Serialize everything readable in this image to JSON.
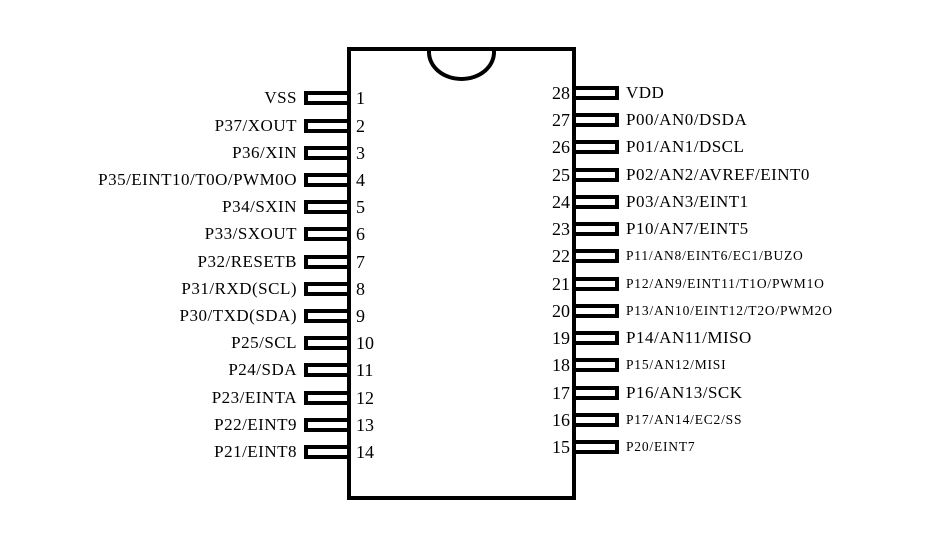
{
  "colors": {
    "line": "#000000",
    "background": "#ffffff"
  },
  "chip": {
    "left_pins": [
      {
        "number": "1",
        "label": "VSS"
      },
      {
        "number": "2",
        "label": "P37/XOUT"
      },
      {
        "number": "3",
        "label": "P36/XIN"
      },
      {
        "number": "4",
        "label": "P35/EINT10/T0O/PWM0O"
      },
      {
        "number": "5",
        "label": "P34/SXIN"
      },
      {
        "number": "6",
        "label": "P33/SXOUT"
      },
      {
        "number": "7",
        "label": "P32/RESETB"
      },
      {
        "number": "8",
        "label": "P31/RXD(SCL)"
      },
      {
        "number": "9",
        "label": "P30/TXD(SDA)"
      },
      {
        "number": "10",
        "label": "P25/SCL"
      },
      {
        "number": "11",
        "label": "P24/SDA"
      },
      {
        "number": "12",
        "label": "P23/EINTA"
      },
      {
        "number": "13",
        "label": "P22/EINT9"
      },
      {
        "number": "14",
        "label": "P21/EINT8"
      }
    ],
    "right_pins": [
      {
        "number": "28",
        "label": "VDD"
      },
      {
        "number": "27",
        "label": "P00/AN0/DSDA"
      },
      {
        "number": "26",
        "label": "P01/AN1/DSCL"
      },
      {
        "number": "25",
        "label": "P02/AN2/AVREF/EINT0"
      },
      {
        "number": "24",
        "label": "P03/AN3/EINT1"
      },
      {
        "number": "23",
        "label": "P10/AN7/EINT5"
      },
      {
        "number": "22",
        "label": "P11/AN8/EINT6/EC1/BUZO"
      },
      {
        "number": "21",
        "label": "P12/AN9/EINT11/T1O/PWM1O"
      },
      {
        "number": "20",
        "label": "P13/AN10/EINT12/T2O/PWM2O"
      },
      {
        "number": "19",
        "label": "P14/AN11/MISO"
      },
      {
        "number": "18",
        "label": "P15/AN12/MISI"
      },
      {
        "number": "17",
        "label": "P16/AN13/SCK"
      },
      {
        "number": "16",
        "label": "P17/AN14/EC2/SS"
      },
      {
        "number": "15",
        "label": "P20/EINT7"
      }
    ]
  }
}
